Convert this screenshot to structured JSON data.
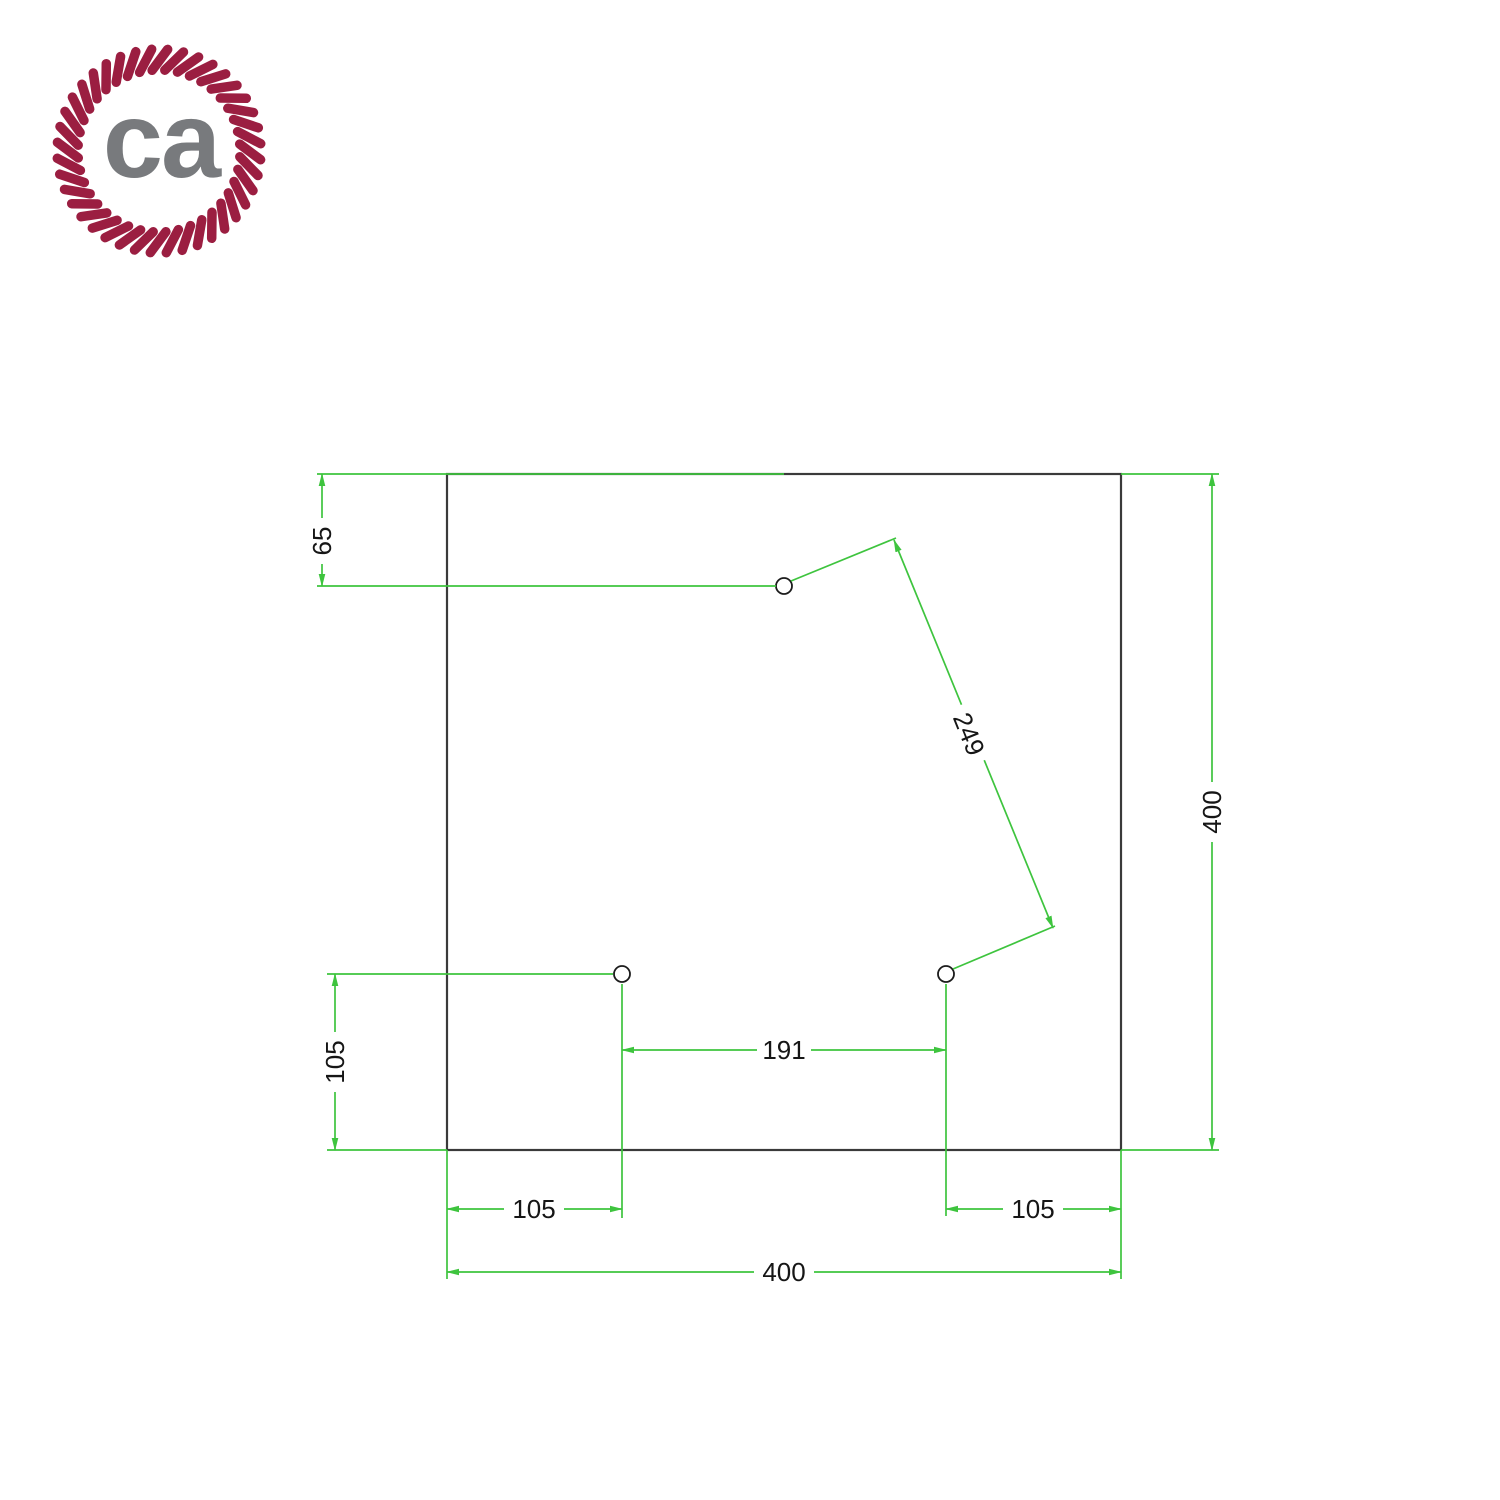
{
  "logo": {
    "text": "ca"
  },
  "colors": {
    "dimension": "#3ec43e",
    "outline": "#3a3a3a",
    "text": "#161616",
    "rope": "#9b1e41",
    "logo_text": "#787a7d"
  },
  "drawing": {
    "dims": {
      "top_hole_from_top": "65",
      "plate_height": "400",
      "left_hole_from_bottom": "105",
      "left_hole_from_left": "105",
      "holes_distance": "191",
      "right_hole_from_right": "105",
      "plate_width": "400",
      "diagonal_holes_distance": "249"
    }
  }
}
